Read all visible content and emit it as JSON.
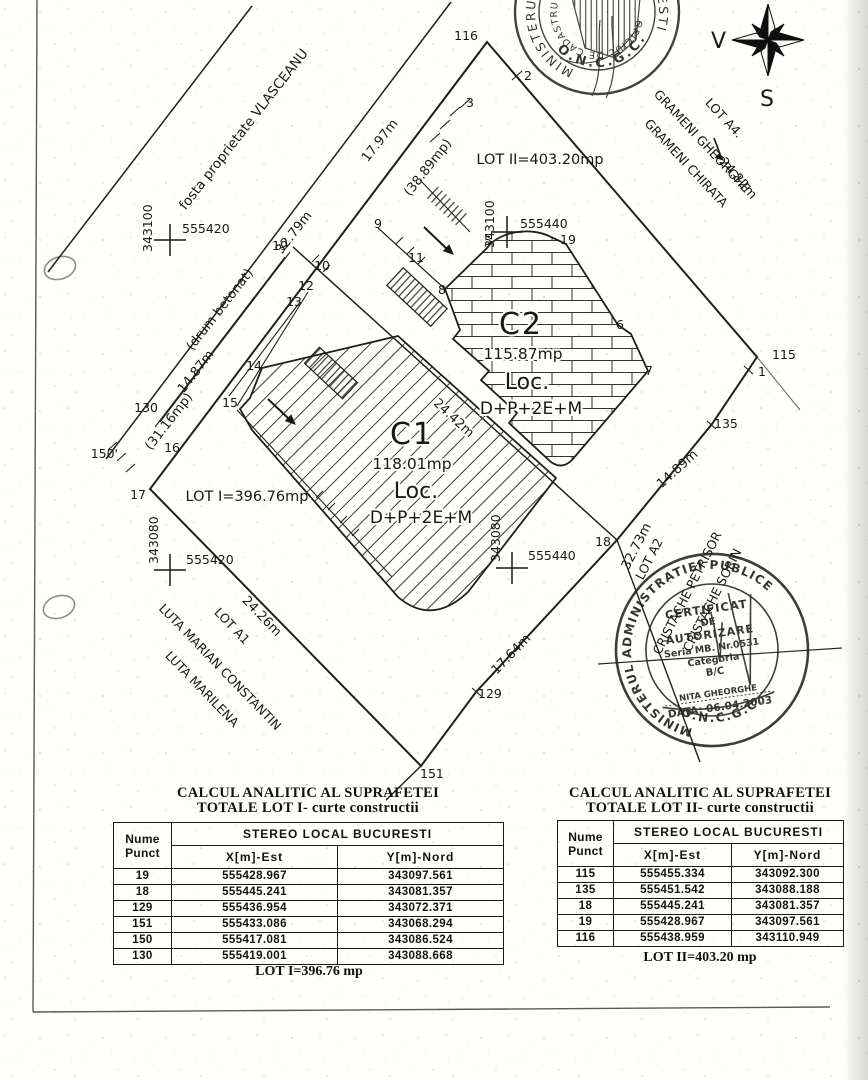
{
  "plan": {
    "neighbors": {
      "vlasceanu": "fosta proprietate VLASCEANU",
      "lot_a4": "LOT A4.",
      "grameni_1": "GRAMENI GHEORGHE",
      "grameni_2": "GRAMENI CHIRATA",
      "lot_a1": "LOT A1",
      "luta_1": "LUTA MARIAN CONSTANTIN",
      "luta_2": "LUTA MARILENA",
      "lot_a2": "LOT A2",
      "cristache_1": "CRISTACHE PETRISOR",
      "cristache_2": "CRISTACHE SORIN"
    },
    "road_name": "(drum betonat)",
    "measurements": {
      "nw_outer": "17.97m",
      "nw_paren": "(38.89mp)",
      "road_1": "32.79m",
      "road_2": "14.87m",
      "road_paren": "(31.16mp)",
      "ne": "24.82m",
      "mid": "24.42m",
      "se_upper": "14.89m",
      "se_lower": "17.64m",
      "sw": "24.26m",
      "a2_side": "32.73m"
    },
    "lots": {
      "lot1_label": "LOT I=396.76mp",
      "lot2_label": "LOT II=403.20mp"
    },
    "buildings": {
      "c1": {
        "id": "C1",
        "area": "118.01mp",
        "use": "Loc.",
        "regime": "D+P+2E+M"
      },
      "c2": {
        "id": "C2",
        "area": "115.87mp",
        "use": "Loc.",
        "regime": "D+P+2E+M"
      }
    },
    "points": [
      "116",
      "2",
      "3",
      "9",
      "19",
      "10",
      "11",
      "12",
      "13",
      "8",
      "14",
      "15",
      "16",
      "17",
      "130",
      "150'",
      "5",
      "19",
      "6",
      "7",
      "115",
      "1",
      "135",
      "18",
      "129",
      "151"
    ],
    "crosses": [
      {
        "northing": "343100",
        "easting": "555420"
      },
      {
        "northing": "343100",
        "easting": "555440"
      },
      {
        "northing": "343080",
        "easting": "555420"
      },
      {
        "northing": "343080",
        "easting": "555440"
      }
    ]
  },
  "compass": {
    "west_label": "V",
    "south_label": "S"
  },
  "stamps": {
    "top": {
      "arc_left": "MINISTERUL",
      "arc_right": "BUCURESTI",
      "arc_inner": "OFICIUL DE CADASTRU GEO",
      "org": "O.N.C.G.C."
    },
    "cert": {
      "arc_top": "MINISTERUL ADMINISTRATIEI PUBLICE",
      "arc_bottom": "O.N.C.G.C.",
      "line1": "CERTIFICAT",
      "line2": "DE",
      "line3": "AUTORIZARE",
      "line4": "Seria MB. Nr.0531",
      "line5": "Categoria",
      "line6": "B/C",
      "line7": "NITA GHEORGHE",
      "line8": "DATA: 06.04.2003"
    }
  },
  "tables": {
    "lot1": {
      "title1": "CALCUL ANALITIC AL SUPRAFETEI",
      "title2": "TOTALE LOT I- curte constructii",
      "head_point1": "Nume",
      "head_point2": "Punct",
      "head_group": "STEREO LOCAL BUCURESTI",
      "head_x": "X[m]-Est",
      "head_y": "Y[m]-Nord",
      "rows": [
        [
          "19",
          "555428.967",
          "343097.561"
        ],
        [
          "18",
          "555445.241",
          "343081.357"
        ],
        [
          "129",
          "555436.954",
          "343072.371"
        ],
        [
          "151",
          "555433.086",
          "343068.294"
        ],
        [
          "150",
          "555417.081",
          "343086.524"
        ],
        [
          "130",
          "555419.001",
          "343088.668"
        ]
      ],
      "total": "LOT I=396.76 mp"
    },
    "lot2": {
      "title1": "CALCUL ANALITIC AL SUPRAFETEI",
      "title2": "TOTALE LOT II- curte constructii",
      "head_point1": "Nume",
      "head_point2": "Punct",
      "head_group": "STEREO LOCAL BUCURESTI",
      "head_x": "X[m]-Est",
      "head_y": "Y[m]-Nord",
      "rows": [
        [
          "115",
          "555455.334",
          "343092.300"
        ],
        [
          "135",
          "555451.542",
          "343088.188"
        ],
        [
          "18",
          "555445.241",
          "343081.357"
        ],
        [
          "19",
          "555428.967",
          "343097.561"
        ],
        [
          "116",
          "555438.959",
          "343110.949"
        ]
      ],
      "total": "LOT II=403.20 mp"
    }
  }
}
